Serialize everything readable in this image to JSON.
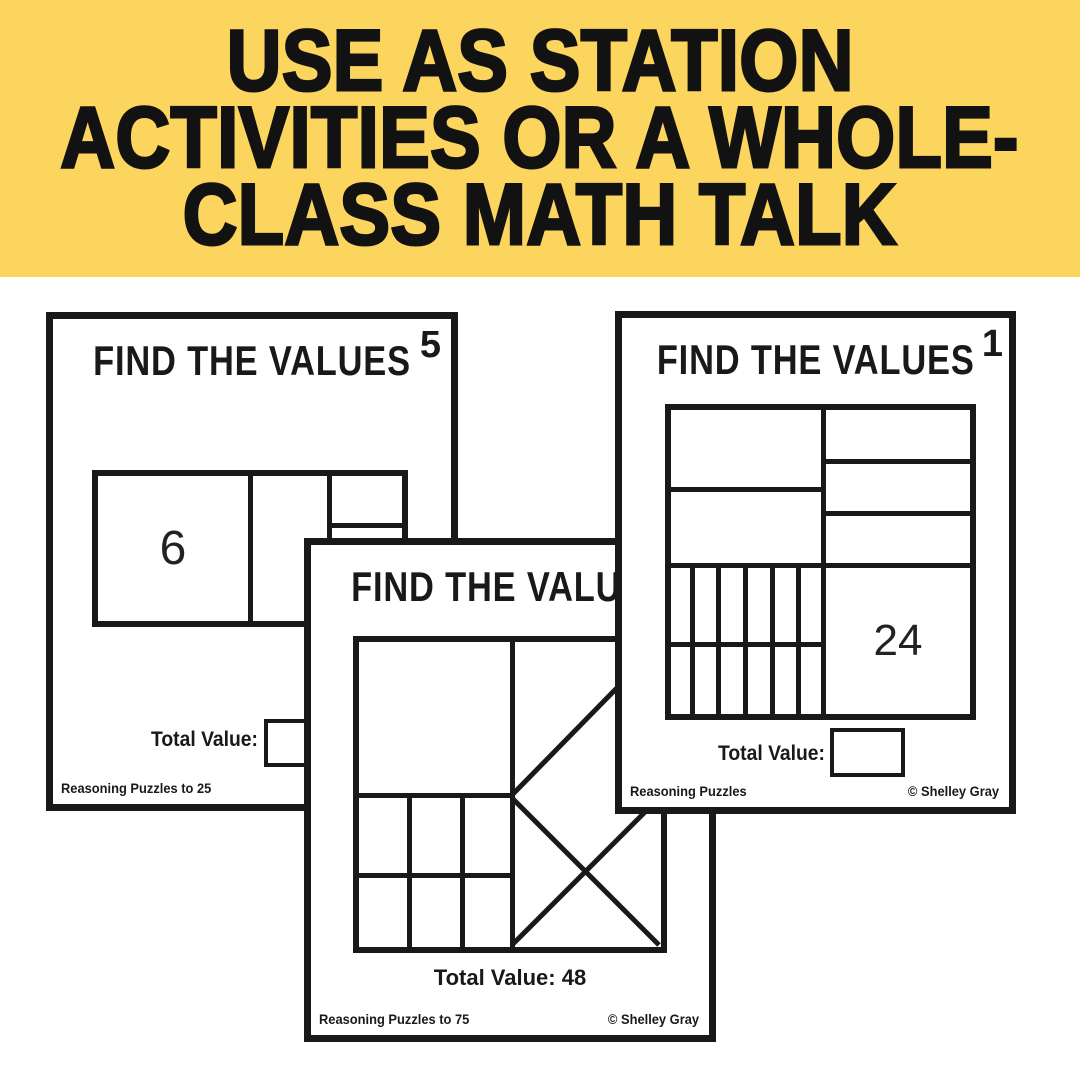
{
  "banner": {
    "bg_color": "#FBD55E",
    "ink_color": "#121212",
    "lines": [
      "USE AS STATION",
      "ACTIVITIES OR A WHOLE-",
      "CLASS MATH TALK"
    ]
  },
  "cards": {
    "left": {
      "title": "FIND THE VALUES",
      "number": "5",
      "cell_value": "6",
      "total_value_label": "Total Value:",
      "footer_left": "Reasoning Puzzles to 25"
    },
    "middle": {
      "title": "FIND THE VALUES",
      "total_value_label": "Total Value: 48",
      "footer_left": "Reasoning Puzzles to 75",
      "footer_right": "© Shelley Gray"
    },
    "right": {
      "title": "FIND THE VALUES",
      "number": "1",
      "cell_value": "24",
      "total_value_label": "Total Value:",
      "footer_left": "Reasoning Puzzles",
      "footer_right": "© Shelley Gray"
    }
  }
}
